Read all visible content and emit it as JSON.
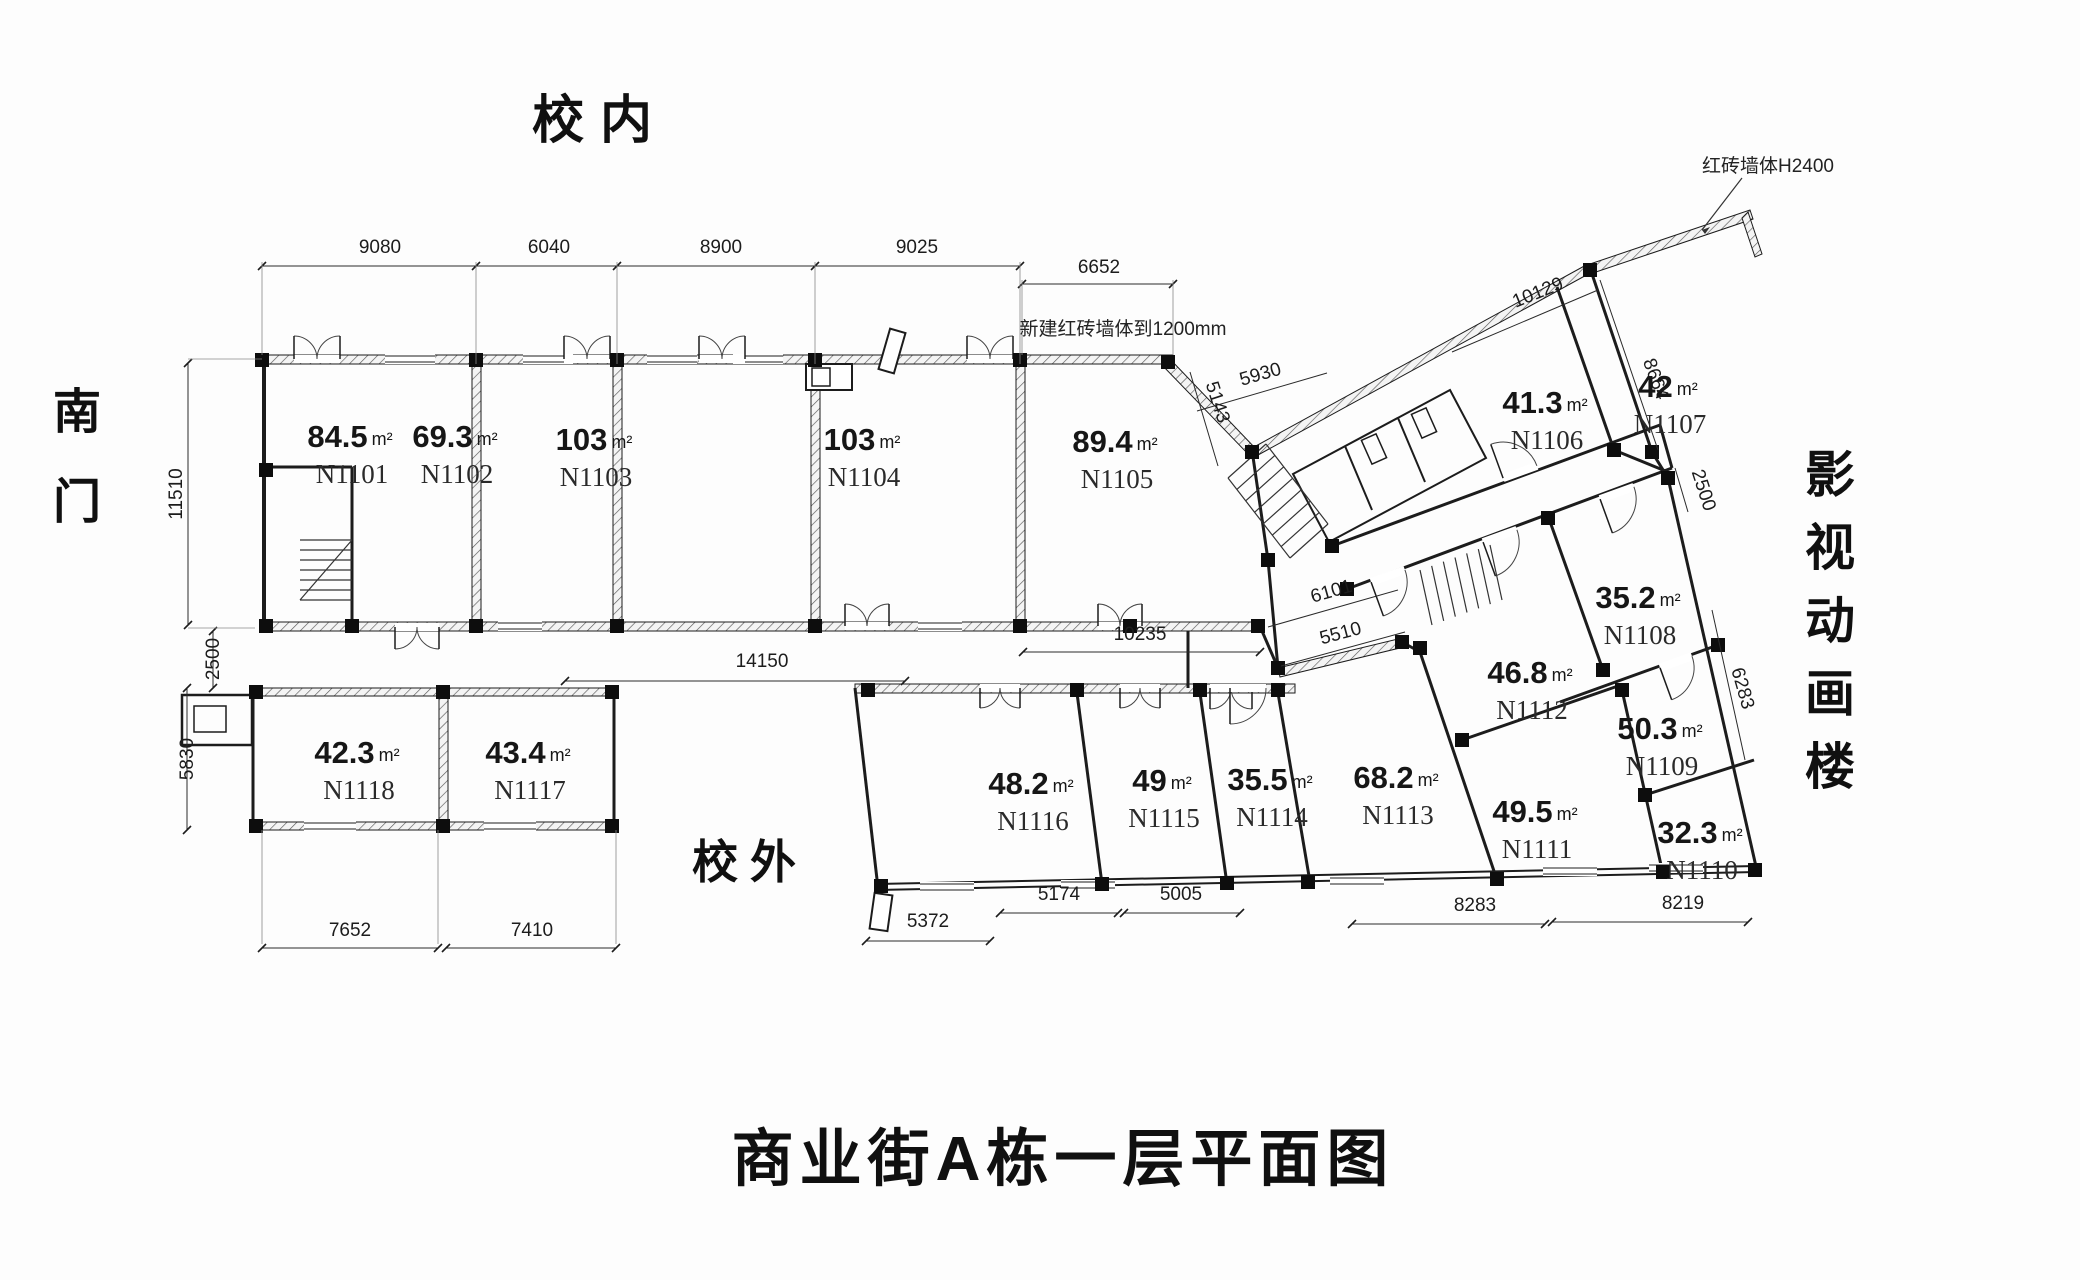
{
  "title": "商业街A栋一层平面图",
  "context_labels": {
    "campus_inside": "校内",
    "south_gate": "南门",
    "campus_outside": "校外",
    "animation_building": "影视动画楼"
  },
  "annotations": {
    "new_brick_wall": "新建红砖墙体到1200mm",
    "brick_wall_height": "红砖墙体H2400"
  },
  "rooms": [
    {
      "id": "N1101",
      "area": "84.5",
      "unit": "m²",
      "x": 350,
      "y": 447
    },
    {
      "id": "N1102",
      "area": "69.3",
      "unit": "m²",
      "x": 455,
      "y": 447
    },
    {
      "id": "N1103",
      "area": "103",
      "unit": "m²",
      "x": 594,
      "y": 450
    },
    {
      "id": "N1104",
      "area": "103",
      "unit": "m²",
      "x": 862,
      "y": 450
    },
    {
      "id": "N1105",
      "area": "89.4",
      "unit": "m²",
      "x": 1115,
      "y": 452
    },
    {
      "id": "N1106",
      "area": "41.3",
      "unit": "m²",
      "x": 1545,
      "y": 413
    },
    {
      "id": "N1107",
      "area": "42",
      "unit": "m²",
      "x": 1668,
      "y": 397
    },
    {
      "id": "N1108",
      "area": "35.2",
      "unit": "m²",
      "x": 1638,
      "y": 608
    },
    {
      "id": "N1109",
      "area": "50.3",
      "unit": "m²",
      "x": 1660,
      "y": 739
    },
    {
      "id": "N1110",
      "area": "32.3",
      "unit": "m²",
      "x": 1700,
      "y": 843
    },
    {
      "id": "N1111",
      "area": "49.5",
      "unit": "m²",
      "x": 1535,
      "y": 822
    },
    {
      "id": "N1112",
      "area": "46.8",
      "unit": "m²",
      "x": 1530,
      "y": 683
    },
    {
      "id": "N1113",
      "area": "68.2",
      "unit": "m²",
      "x": 1396,
      "y": 788
    },
    {
      "id": "N1114",
      "area": "35.5",
      "unit": "m²",
      "x": 1270,
      "y": 790
    },
    {
      "id": "N1115",
      "area": "49",
      "unit": "m²",
      "x": 1162,
      "y": 791
    },
    {
      "id": "N1116",
      "area": "48.2",
      "unit": "m²",
      "x": 1031,
      "y": 794
    },
    {
      "id": "N1117",
      "area": "43.4",
      "unit": "m²",
      "x": 528,
      "y": 763
    },
    {
      "id": "N1118",
      "area": "42.3",
      "unit": "m²",
      "x": 357,
      "y": 763
    }
  ],
  "dimensions": [
    {
      "v": "9080",
      "x": 380,
      "y": 253,
      "r": 0
    },
    {
      "v": "6040",
      "x": 549,
      "y": 253,
      "r": 0
    },
    {
      "v": "8900",
      "x": 721,
      "y": 253,
      "r": 0
    },
    {
      "v": "9025",
      "x": 917,
      "y": 253,
      "r": 0
    },
    {
      "v": "6652",
      "x": 1099,
      "y": 273,
      "r": 0
    },
    {
      "v": "11510",
      "x": 182,
      "y": 494,
      "r": -90
    },
    {
      "v": "2500",
      "x": 219,
      "y": 659,
      "r": -90
    },
    {
      "v": "5830",
      "x": 193,
      "y": 759,
      "r": -90
    },
    {
      "v": "7652",
      "x": 350,
      "y": 936,
      "r": 0
    },
    {
      "v": "7410",
      "x": 532,
      "y": 936,
      "r": 0
    },
    {
      "v": "14150",
      "x": 762,
      "y": 667,
      "r": 0
    },
    {
      "v": "10235",
      "x": 1140,
      "y": 640,
      "r": 0
    },
    {
      "v": "5143",
      "x": 1212,
      "y": 404,
      "r": 72
    },
    {
      "v": "5930",
      "x": 1262,
      "y": 380,
      "r": -16
    },
    {
      "v": "6101",
      "x": 1333,
      "y": 597,
      "r": -16
    },
    {
      "v": "5510",
      "x": 1342,
      "y": 639,
      "r": -15
    },
    {
      "v": "10129",
      "x": 1540,
      "y": 298,
      "r": -22
    },
    {
      "v": "8664",
      "x": 1650,
      "y": 381,
      "r": 70
    },
    {
      "v": "2500",
      "x": 1698,
      "y": 492,
      "r": 72
    },
    {
      "v": "6283",
      "x": 1737,
      "y": 690,
      "r": 74
    },
    {
      "v": "5372",
      "x": 928,
      "y": 927,
      "r": 0
    },
    {
      "v": "5174",
      "x": 1059,
      "y": 900,
      "r": 0
    },
    {
      "v": "5005",
      "x": 1181,
      "y": 900,
      "r": 0
    },
    {
      "v": "8283",
      "x": 1475,
      "y": 911,
      "r": 0
    },
    {
      "v": "8219",
      "x": 1683,
      "y": 909,
      "r": 0
    }
  ],
  "colors": {
    "line": "#1c1c1c",
    "background": "#ffffff"
  }
}
